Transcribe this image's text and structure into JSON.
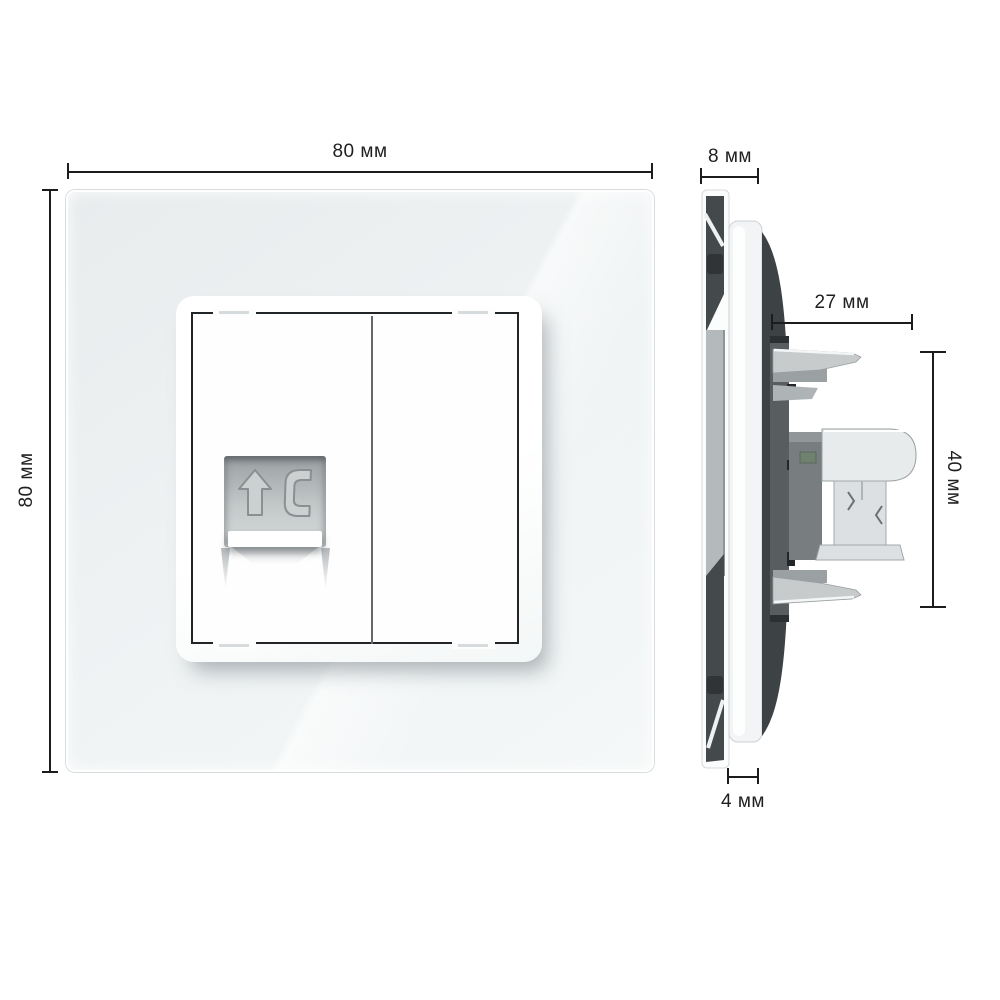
{
  "diagram": {
    "type": "product-dimension-drawing",
    "views": {
      "front": {
        "dimensions": {
          "width": "80 мм",
          "height": "80 мм"
        },
        "socket_icons": [
          "arrow-up",
          "phone-handset"
        ]
      },
      "side": {
        "dimensions": {
          "frame_thickness": "8 мм",
          "mechanism_depth": "27 мм",
          "mechanism_height": "40 мм",
          "plate_thickness": "4 мм"
        }
      }
    },
    "colors": {
      "glass_tint": "#eef2f3",
      "plate_white": "#fdfdfd",
      "frame_line": "#212528",
      "recess_gray": "#c3c8c9",
      "mechanism_dark": "#3d4245",
      "claw_light": "#c7cbcc",
      "dimension_line": "#1c1c1c"
    }
  }
}
